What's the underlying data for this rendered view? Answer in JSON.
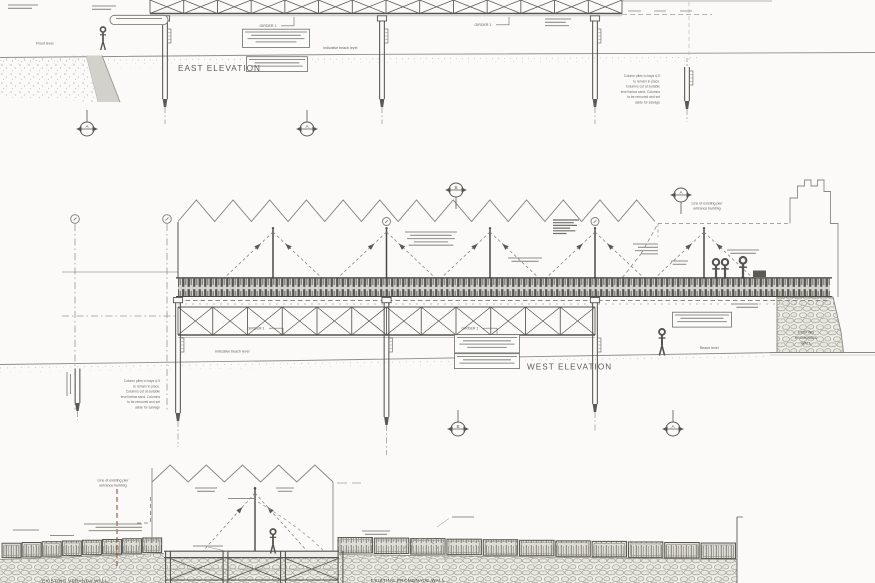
{
  "drawing": {
    "background": "#fbfaf8",
    "ink": "#55544f",
    "accent_red": "#94503f",
    "titles": {
      "east": "EAST ELEVATION",
      "west": "WEST ELEVATION"
    },
    "labels": {
      "girder": "GIRDER 1",
      "indicative_beach": "Indicative beach level",
      "flood_level": "Flood level",
      "beach_level": "Beach level",
      "entrance_building": [
        "Line of existing pier",
        "entrance building"
      ],
      "promenade_wall": [
        "EXISTING",
        "PROMENADE",
        "WALL"
      ],
      "promenade_wall_bottom": "EXISTING PROMENADE WALL",
      "veranda_bottom": "EXISTING VERANDA WALL"
    },
    "notes": {
      "column_piles": [
        "Column piles to bays 6-9",
        "to remain in place.",
        "Columns cut at suitable",
        "level below sand. Columns",
        "to be removed and set",
        "aside for salvage"
      ]
    },
    "section_markers": {
      "east": [
        "A",
        "A"
      ],
      "west_top": [
        "B",
        "A"
      ],
      "west_bottom": [
        "B",
        "A"
      ]
    },
    "illegible_notes": [
      {
        "x": 8,
        "y": 5,
        "w": 30,
        "lines": 2,
        "align": "left"
      },
      {
        "x": 92,
        "y": 6,
        "w": 24,
        "lines": 2,
        "align": "left"
      },
      {
        "x": 116,
        "y": 18.5,
        "w": 46,
        "lines": 1,
        "align": "left",
        "pill": true
      },
      {
        "x": 245,
        "y": 32,
        "w": 62,
        "lines": 4,
        "boxed": true,
        "align": "center"
      },
      {
        "x": 249,
        "y": 59.5,
        "w": 56,
        "lines": 3,
        "boxed": true,
        "align": "center"
      },
      {
        "x": 545,
        "y": 19,
        "w": 26,
        "lines": 3,
        "align": "left"
      },
      {
        "x": 405,
        "y": 232,
        "w": 52,
        "lines": 5,
        "align": "center"
      },
      {
        "x": 553,
        "y": 220,
        "w": 26,
        "lines": 6,
        "dense": true,
        "align": "left"
      },
      {
        "x": 633,
        "y": 244,
        "w": 25,
        "lines": 4,
        "align": "right"
      },
      {
        "x": 508,
        "y": 258,
        "w": 34,
        "lines": 2,
        "align": "center"
      },
      {
        "x": 727,
        "y": 250,
        "w": 32,
        "lines": 2,
        "align": "center"
      },
      {
        "x": 671,
        "y": 261,
        "w": 17,
        "lines": 2,
        "align": "center"
      },
      {
        "x": 675,
        "y": 315,
        "w": 54,
        "lines": 3,
        "boxed": true,
        "align": "center"
      },
      {
        "x": 731,
        "y": 304,
        "w": 27,
        "lines": 2,
        "align": "right"
      },
      {
        "x": 457,
        "y": 337.5,
        "w": 60,
        "lines": 4,
        "boxed": true,
        "align": "center"
      },
      {
        "x": 457,
        "y": 356.5,
        "w": 60,
        "lines": 3,
        "boxed": true,
        "align": "center"
      },
      {
        "x": 195,
        "y": 488,
        "w": 22,
        "lines": 2,
        "align": "center"
      },
      {
        "x": 276,
        "y": 488,
        "w": 18,
        "lines": 2,
        "align": "center"
      },
      {
        "x": 228,
        "y": 498.5,
        "w": 26,
        "lines": 1,
        "align": "center"
      },
      {
        "x": 84,
        "y": 524,
        "w": 58,
        "lines": 3,
        "align": "right"
      },
      {
        "x": 13,
        "y": 530,
        "w": 26,
        "lines": 1,
        "align": "left"
      },
      {
        "x": 50,
        "y": 535.5,
        "w": 24,
        "lines": 1,
        "align": "left"
      },
      {
        "x": 193,
        "y": 546,
        "w": 30,
        "lines": 1,
        "align": "left"
      },
      {
        "x": 362,
        "y": 531,
        "w": 28,
        "lines": 2,
        "align": "center"
      },
      {
        "x": 452,
        "y": 517,
        "w": 22,
        "lines": 1,
        "align": "left"
      }
    ]
  }
}
